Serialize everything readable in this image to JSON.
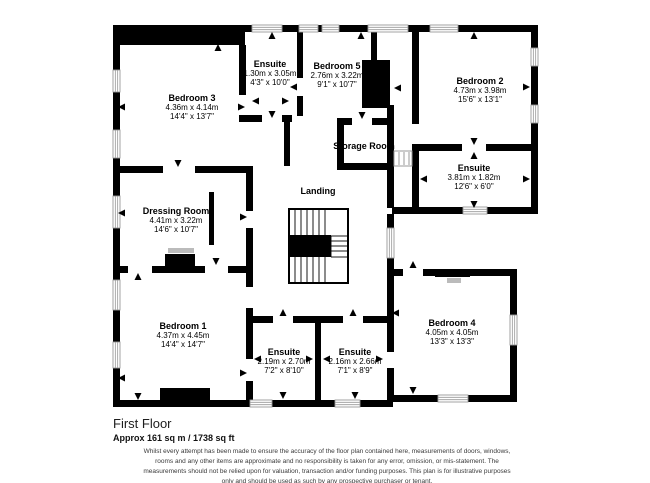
{
  "plan": {
    "floor_title": "First Floor",
    "area_text": "Approx 161 sq m / 1738 sq ft",
    "disclaimer": "Whilst every attempt has been made to ensure the accuracy of the floor plan contained here, measurements of doors, windows, rooms and any other items are approximate and no responsibility is taken for any error, omission, or mis-statement. The measurements should not be relied upon for valuation, transaction and/or funding purposes. This plan is for illustrative purposes only and should be used as such by any prospective purchaser or tenant."
  },
  "rooms": [
    {
      "id": "bedroom-3",
      "name": "Bedroom 3",
      "metric": "4.36m x 4.14m",
      "imperial": "14'4\" x 13'7\""
    },
    {
      "id": "ensuite-bedroom-3",
      "name": "Ensuite",
      "metric": "1.30m x 3.05m",
      "imperial": "4'3\" x 10'0\""
    },
    {
      "id": "bedroom-5",
      "name": "Bedroom 5",
      "metric": "2.76m x 3.22m",
      "imperial": "9'1\" x 10'7\""
    },
    {
      "id": "bedroom-2",
      "name": "Bedroom 2",
      "metric": "4.73m x 3.98m",
      "imperial": "15'6\" x 13'1\""
    },
    {
      "id": "storage-room",
      "name": "Storage Room"
    },
    {
      "id": "ensuite-bedroom-2",
      "name": "Ensuite",
      "metric": "3.81m x 1.82m",
      "imperial": "12'6\" x 6'0\""
    },
    {
      "id": "landing",
      "name": "Landing"
    },
    {
      "id": "dressing-room",
      "name": "Dressing Room",
      "metric": "4.41m x 3.22m",
      "imperial": "14'6\" x 10'7\""
    },
    {
      "id": "bedroom-1",
      "name": "Bedroom 1",
      "metric": "4.37m x 4.45m",
      "imperial": "14'4\" x 14'7\""
    },
    {
      "id": "ensuite-bedroom-1",
      "name": "Ensuite",
      "metric": "2.19m x 2.70m",
      "imperial": "7'2\" x 8'10\""
    },
    {
      "id": "ensuite-middle",
      "name": "Ensuite",
      "metric": "2.16m x 2.66m",
      "imperial": "7'1\" x 8'9\""
    },
    {
      "id": "bedroom-4",
      "name": "Bedroom 4",
      "metric": "4.05m x 4.05m",
      "imperial": "13'3\" x 13'3\""
    }
  ],
  "colors": {
    "wall": "#000000",
    "window_frame": "#999999",
    "furniture_accent": "#bbbbbb",
    "background": "#ffffff"
  }
}
